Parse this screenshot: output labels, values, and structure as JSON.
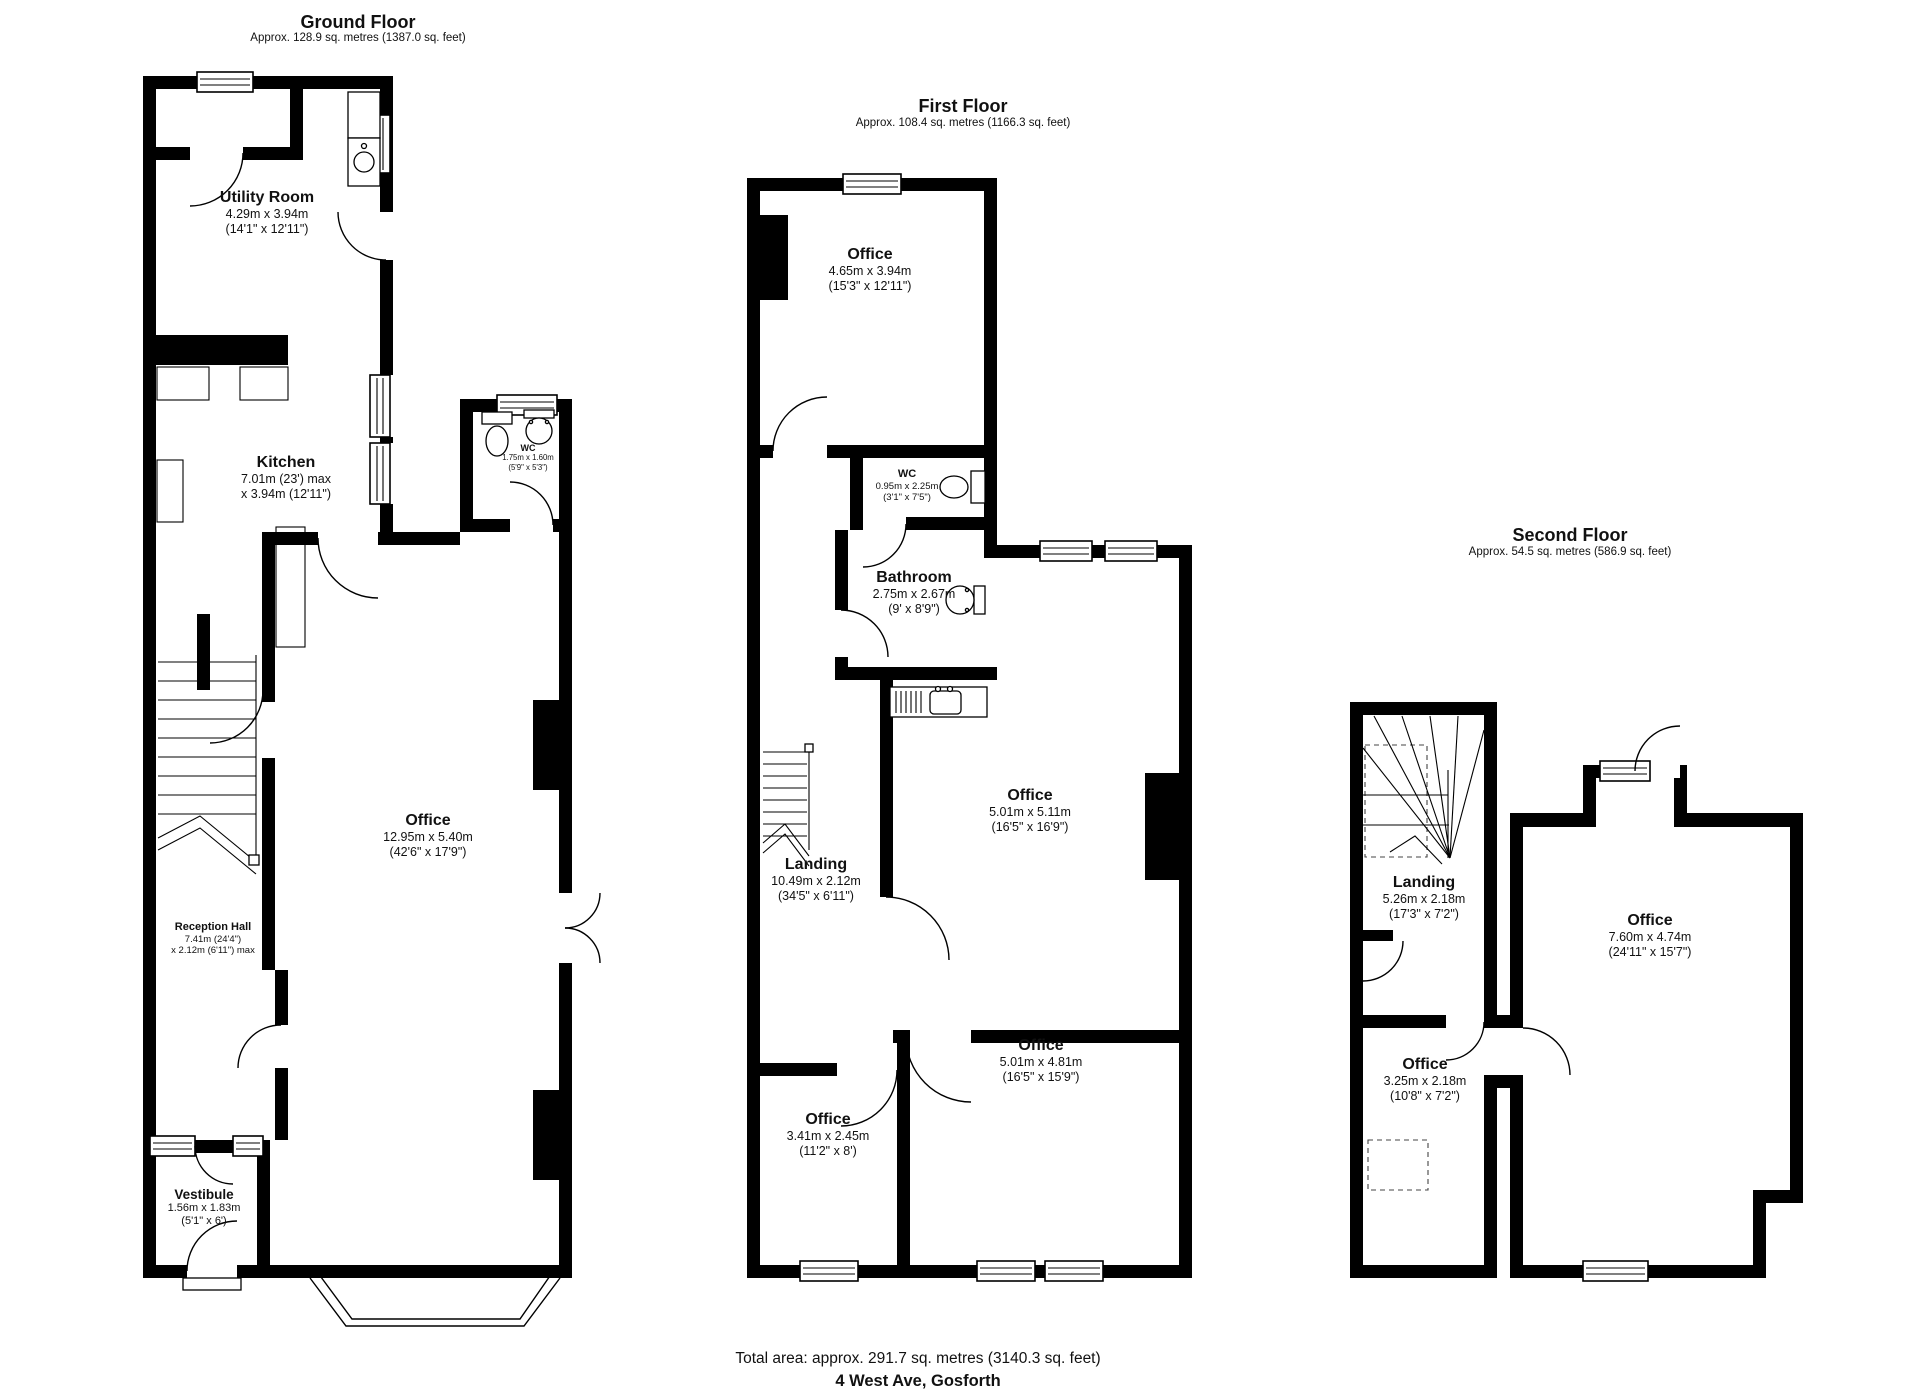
{
  "page": {
    "footer_total": "Total area: approx. 291.7 sq. metres (3140.3 sq. feet)",
    "footer_address": "4 West Ave, Gosforth",
    "wall_color": "#000000",
    "background_color": "#ffffff"
  },
  "floors": [
    {
      "title": "Ground Floor",
      "area": "Approx. 128.9 sq. metres (1387.0 sq. feet)",
      "rooms": [
        {
          "name": "Utility Room",
          "dims1": "4.29m x 3.94m",
          "dims2": "(14'1\" x 12'11\")"
        },
        {
          "name": "Kitchen",
          "dims1": "7.01m (23') max",
          "dims2": "x 3.94m (12'11\")"
        },
        {
          "name": "WC",
          "dims1": "1.75m x 1.60m",
          "dims2": "(5'9\" x 5'3\")"
        },
        {
          "name": "Office",
          "dims1": "12.95m x 5.40m",
          "dims2": "(42'6\" x 17'9\")"
        },
        {
          "name": "Reception Hall",
          "dims1": "7.41m (24'4\")",
          "dims2": "x 2.12m (6'11\") max"
        },
        {
          "name": "Vestibule",
          "dims1": "1.56m x 1.83m",
          "dims2": "(5'1\" x 6')"
        }
      ]
    },
    {
      "title": "First Floor",
      "area": "Approx. 108.4 sq. metres (1166.3 sq. feet)",
      "rooms": [
        {
          "name": "Office",
          "dims1": "4.65m x 3.94m",
          "dims2": "(15'3\" x 12'11\")"
        },
        {
          "name": "WC",
          "dims1": "0.95m x 2.25m",
          "dims2": "(3'1\" x 7'5\")"
        },
        {
          "name": "Bathroom",
          "dims1": "2.75m x 2.67m",
          "dims2": "(9' x 8'9\")"
        },
        {
          "name": "Office",
          "dims1": "5.01m x 5.11m",
          "dims2": "(16'5\" x 16'9\")"
        },
        {
          "name": "Landing",
          "dims1": "10.49m x 2.12m",
          "dims2": "(34'5\" x 6'11\")"
        },
        {
          "name": "Office",
          "dims1": "3.41m x 2.45m",
          "dims2": "(11'2\" x 8')"
        },
        {
          "name": "Office",
          "dims1": "5.01m x 4.81m",
          "dims2": "(16'5\" x 15'9\")"
        }
      ]
    },
    {
      "title": "Second Floor",
      "area": "Approx. 54.5 sq. metres (586.9 sq. feet)",
      "rooms": [
        {
          "name": "Landing",
          "dims1": "5.26m x 2.18m",
          "dims2": "(17'3\" x 7'2\")"
        },
        {
          "name": "Office",
          "dims1": "7.60m x 4.74m",
          "dims2": "(24'11\" x 15'7\")"
        },
        {
          "name": "Office",
          "dims1": "3.25m x 2.18m",
          "dims2": "(10'8\" x 7'2\")"
        }
      ]
    }
  ]
}
